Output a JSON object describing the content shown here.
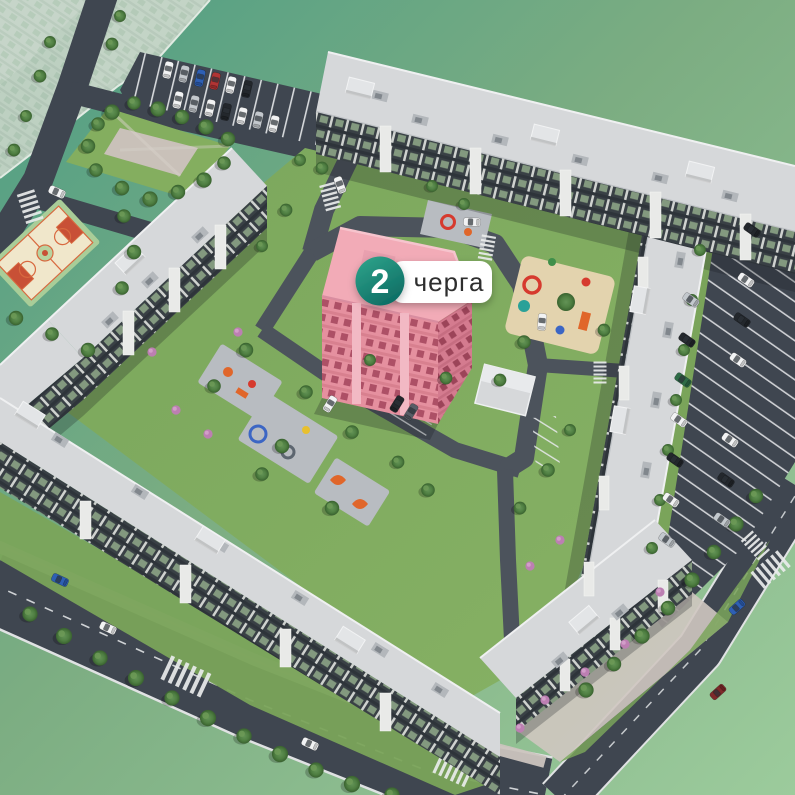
{
  "scene": {
    "description": "aerial-3d-masterplan-of-residential-complex",
    "highlighted_building": "phase-2-building"
  },
  "phase_marker": {
    "number": "2",
    "label": "черга"
  },
  "colors": {
    "backdrop_top_left": "#4e9e85",
    "backdrop_mid": "#7cad82",
    "backdrop_bottom_right": "#9ccb9c",
    "asphalt": "#3f4650",
    "asphalt_light": "#4c535c",
    "road_edge": "#e0e2e3",
    "grass": "#7aa45a",
    "grass_light": "#86b164",
    "park_grass": "#84ae5f",
    "roof_light": "#d6d8da",
    "roof_white": "#eff0f1",
    "roof_detail": "#b3b7bb",
    "facade_dark": "#394045",
    "facade_light": "#e9eae8",
    "window_glass": "#83997f",
    "sidewalk": "#cbc4be",
    "sand": "#e3d3ae",
    "pad_gray": "#b8bcc1",
    "play_orange": "#e0662a",
    "play_red": "#d63a2e",
    "play_blue": "#3c66c4",
    "play_yellow": "#e8c02e",
    "play_teal": "#2aa198",
    "court_band": "#a9cd98",
    "court_floor": "#f0e7cb",
    "court_red": "#c85036",
    "court_line": "#d8693f",
    "highlight_roof": "#f2abb7",
    "highlight_wall": "#e5909f",
    "highlight_shade": "#d47b8f",
    "highlight_window": "#ad5066",
    "badge_top": "#2da189",
    "badge_bottom": "#0c6a62",
    "pill_bg": "#ffffff",
    "pill_text": "#2e2e2e",
    "badge_number": "#ffffff",
    "faded_wall": "#c2d2c4",
    "shrub_pink": "#bc7fb2",
    "tree_dark": "#39622f",
    "tree_mid": "#5c8a4c",
    "car_white": "#f2f3f4",
    "car_silver": "#c3c8cd",
    "car_black": "#23272c",
    "car_red": "#b13434",
    "car_blue": "#2e5fb4",
    "car_green": "#2e6b46",
    "car_darkred": "#7e2a2a",
    "car_darkgray": "#565d66"
  }
}
